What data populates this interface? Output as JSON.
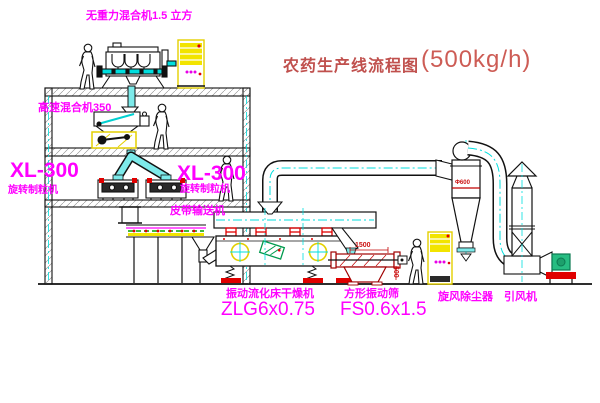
{
  "diagram": {
    "title": {
      "name": "农药生产线流程图",
      "capacity": "(500kg/h)"
    },
    "labels": {
      "gravity_mixer": "无重力混合机1.5 立方",
      "high_speed_mixer": "高速混合机350",
      "granulator_left_model": "XL-300",
      "granulator_left_name": "旋转制粒机",
      "granulator_right_model": "XL-300",
      "granulator_right_name": "旋转制粒机",
      "belt_conveyor": "皮带输送机",
      "dryer_name": "振动流化床干燥机",
      "dryer_model": "ZLG6x0.75",
      "screen_name": "方形振动筛",
      "screen_model": "FS0.6x1.5",
      "cyclone": "旋风除尘器",
      "fan": "引风机"
    },
    "dimensions": {
      "screen_length": "1500",
      "screen_width": "500",
      "cyclone_diameter": "Φ600"
    },
    "colors": {
      "label_magenta": "#ff00ff",
      "title_red": "#c0504d",
      "pipe_cyan": "#00dede",
      "equipment_yellow": "#f2e400",
      "accent_red": "#e00000",
      "line_black": "#111111",
      "belt_green": "#00a000",
      "motor_green": "#27bd82",
      "screen_red": "#a00000"
    }
  }
}
